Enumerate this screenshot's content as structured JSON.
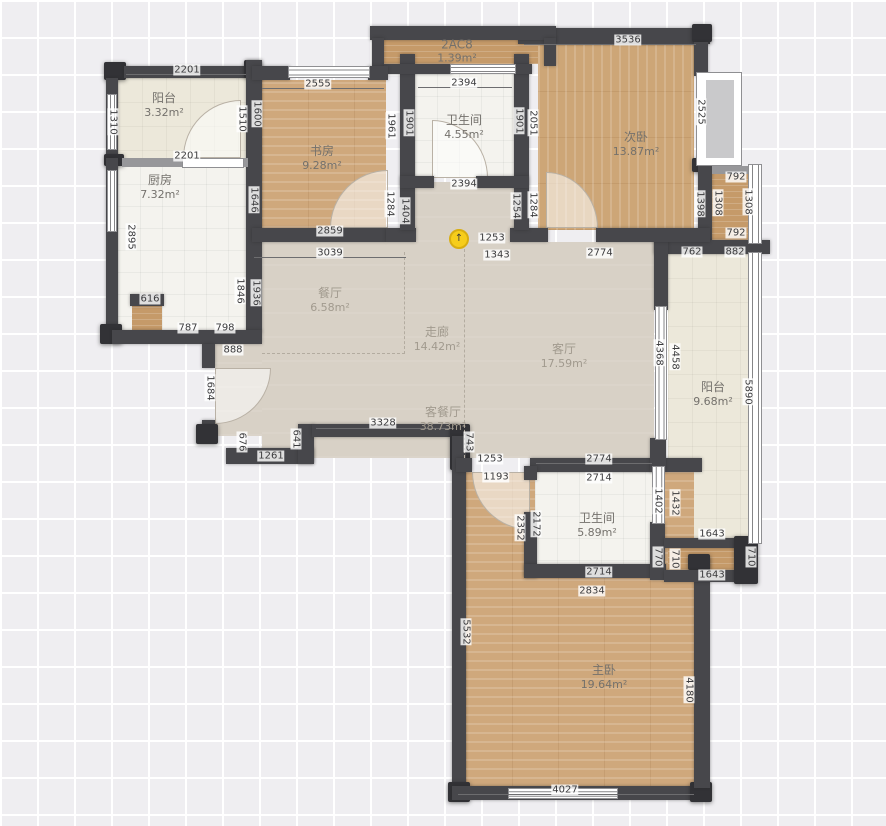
{
  "plan_title": "apartment-floor-plan",
  "rooms": {
    "balcony_tl": {
      "name": "阳台",
      "area": "3.32m²"
    },
    "kitchen": {
      "name": "厨房",
      "area": "7.32m²"
    },
    "study": {
      "name": "书房",
      "area": "9.28m²"
    },
    "bath1": {
      "name": "卫生间",
      "area": "4.55m²"
    },
    "bedroom2": {
      "name": "次卧",
      "area": "13.87m²"
    },
    "ac1": {
      "name": "2AC8",
      "area": "1.39m²"
    },
    "dining": {
      "name": "餐厅",
      "area": "6.58m²"
    },
    "corridor": {
      "name": "走廊",
      "area": "14.42m²"
    },
    "living": {
      "name": "客厅",
      "area": "17.59m²"
    },
    "balcony_r": {
      "name": "阳台",
      "area": "9.68m²"
    },
    "living_dining": {
      "name": "客餐厅",
      "area": "38.73m²"
    },
    "bath2": {
      "name": "卫生间",
      "area": "5.89m²"
    },
    "master": {
      "name": "主卧",
      "area": "19.64m²"
    }
  },
  "icons": {
    "lamp": "↑"
  },
  "colors": {
    "wall": "#47474b",
    "wood": "#cfa87c",
    "tile": "#f4f3ee",
    "living_floor": "#d8d1c6",
    "lamp": "#f6cd1b"
  },
  "dims": {
    "k2201a": "2201",
    "k2201b": "2201",
    "k2555": "2555",
    "k2394a": "2394",
    "k3536": "3536",
    "k2394b": "2394",
    "k2859": "2859",
    "k3039": "3039",
    "k1253a": "1253",
    "k1343": "1343",
    "k2774a": "2774",
    "k762": "762",
    "k882": "882",
    "k792a": "792",
    "k792b": "792",
    "k616": "616",
    "k787": "787",
    "k798": "798",
    "k888": "888",
    "k1261": "1261",
    "k3328": "3328",
    "k1253b": "1253",
    "k1193": "1193",
    "k2774b": "2774",
    "k2714a": "2714",
    "k1643a": "1643",
    "k1643b": "1643",
    "k2714b": "2714",
    "k2834": "2834",
    "k4027": "4027",
    "k1310": "1310",
    "k1510": "1510",
    "k1600": "1600",
    "k2895": "2895",
    "k1646": "1646",
    "k1961": "1961",
    "k1901a": "1901",
    "k1901b": "1901",
    "k2051": "2051",
    "k1284a": "1284",
    "k1404": "1404",
    "k1254": "1254",
    "k1284b": "1284",
    "k2525": "2525",
    "k1398": "1398",
    "k1308a": "1308",
    "k1308b": "1308",
    "k1846": "1846",
    "k1936": "1936",
    "k1684": "1684",
    "k676": "676",
    "k641": "641",
    "k743": "743",
    "k4368": "4368",
    "k4458": "4458",
    "k5890": "5890",
    "k2352": "2352",
    "k2172": "2172",
    "k1402": "1402",
    "k1432": "1432",
    "k770": "770",
    "k710a": "710",
    "k710b": "710",
    "k5532": "5532",
    "k4180": "4180"
  }
}
